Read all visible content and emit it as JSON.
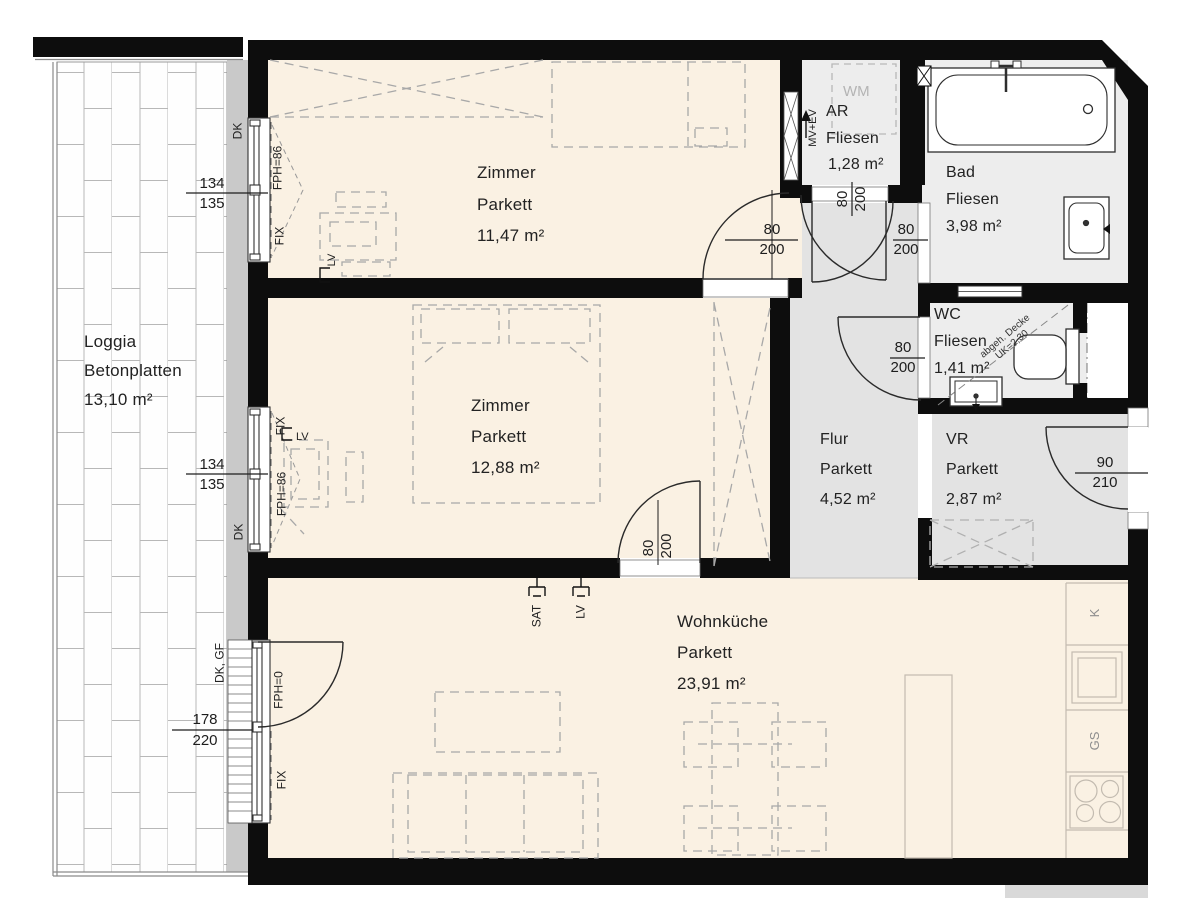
{
  "rooms": {
    "loggia": {
      "name": "Loggia",
      "surface": "Betonplatten",
      "area": "13,10 m²"
    },
    "zimmer1": {
      "name": "Zimmer",
      "surface": "Parkett",
      "area": "11,47 m²"
    },
    "zimmer2": {
      "name": "Zimmer",
      "surface": "Parkett",
      "area": "12,88 m²"
    },
    "wohnkueche": {
      "name": "Wohnküche",
      "surface": "Parkett",
      "area": "23,91 m²"
    },
    "ar": {
      "name": "AR",
      "surface": "Fliesen",
      "area": "1,28 m²",
      "appliance": "WM"
    },
    "bad": {
      "name": "Bad",
      "surface": "Fliesen",
      "area": "3,98 m²"
    },
    "wc": {
      "name": "WC",
      "surface": "Fliesen",
      "area": "1,41 m²",
      "ceiling_note_line1": "abgeh. Decke",
      "ceiling_note_line2": "UK=2,30"
    },
    "flur": {
      "name": "Flur",
      "surface": "Parkett",
      "area": "4,52 m²"
    },
    "vr": {
      "name": "VR",
      "surface": "Parkett",
      "area": "2,87 m²"
    }
  },
  "doors": {
    "zimmer1_door": {
      "width": "80",
      "height": "200"
    },
    "ar_door": {
      "width": "80",
      "height": "200"
    },
    "bad_door": {
      "width": "80",
      "height": "200"
    },
    "wc_door": {
      "width": "80",
      "height": "200"
    },
    "wohnkueche_door": {
      "width": "80",
      "height": "200"
    },
    "entry_door": {
      "width": "90",
      "height": "210"
    }
  },
  "windows": {
    "window1": {
      "width": "134",
      "height": "135",
      "opening": "DK",
      "parapet": "FPH=86",
      "frame": "FIX"
    },
    "window2": {
      "width": "134",
      "height": "135",
      "opening": "DK",
      "parapet": "FPH=86",
      "frame": "FIX"
    },
    "terrace_door": {
      "width": "178",
      "height": "220",
      "opening": "DK, GF",
      "parapet": "FPH=0",
      "frame": "FIX"
    }
  },
  "services": {
    "ventilation": "MV+EV",
    "sat_outlet": "SAT",
    "light_outlet": "LV",
    "zimmer1_outlet": "LV",
    "zimmer2_outlet": "LV"
  },
  "kitchen": {
    "fridge": "K",
    "dishwasher": "GS"
  },
  "colors": {
    "wall": "#0d0d0d",
    "floor_wood": "#faf1e3",
    "floor_tile": "#ededed",
    "floor_corridor": "#e3e3e3",
    "outer_wall": "#c9c9c9"
  }
}
